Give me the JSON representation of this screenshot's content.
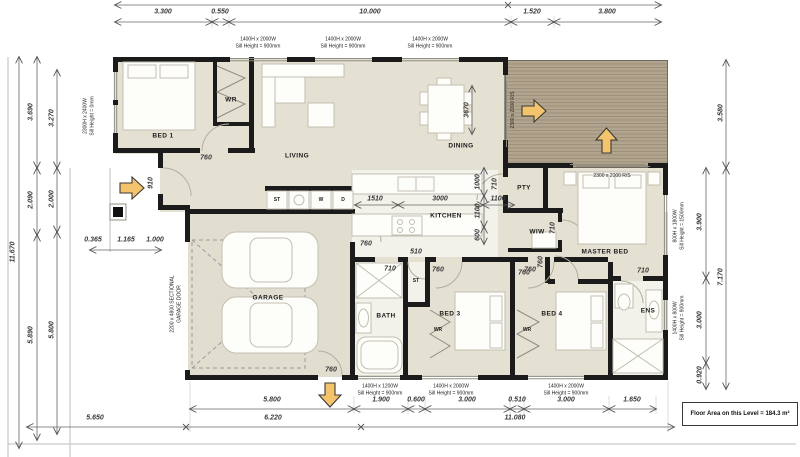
{
  "title": {
    "floor_area": "Floor Area on this Level = 184.3 m²"
  },
  "dims": {
    "top": [
      "3.300",
      "0.550",
      "10.000",
      "1.520",
      "3.800"
    ],
    "bottom_row1": [
      "5.800",
      "1.900",
      "0.600",
      "3.000",
      "0.510",
      "3.000",
      "1.650"
    ],
    "bottom_row2": [
      "5.650",
      "6.220",
      "11.080"
    ],
    "left_outer": "11.670",
    "left_mid": [
      "3.690",
      "2.090",
      "5.890"
    ],
    "left_inner": [
      "3.270",
      "2.000",
      "5.800"
    ],
    "left_entry": [
      "0.365",
      "1.165",
      "1.000"
    ],
    "right_outer": [
      "3.580",
      "7.170"
    ],
    "right_inner": [
      "3.900",
      "3.000",
      "0.920"
    ]
  },
  "interior_dims": {
    "kitchen_row": [
      "1510",
      "3000",
      "1100"
    ],
    "kitchen_col": [
      "1000",
      "1100",
      "600"
    ],
    "dining_table": "3670",
    "entry_door": "910",
    "bed1_door": "760",
    "hall_door": "760",
    "pantry_door": "710",
    "wiw_door": "710",
    "master_door_a": "760",
    "master_door_b": "760",
    "bath_door": "710",
    "store_door": "510",
    "bed3_door": "760",
    "bed4_door": "760",
    "ens_door": "710",
    "garage_rear_door": "760"
  },
  "rooms": {
    "bed1": "BED 1",
    "wr1": "WR",
    "living": "LIVING",
    "dining": "DINING",
    "kitchen": "KITCHEN",
    "pantry": "PTY",
    "wiw": "WIW",
    "master": "MASTER BED",
    "garage": "GARAGE",
    "laundry_store": "ST",
    "washer": "W",
    "dryer": "D",
    "hall_store": "ST",
    "bath": "BATH",
    "wr3": "WR",
    "bed3": "BED 3",
    "wr4": "WR",
    "bed4": "BED 4",
    "ens": "ENS"
  },
  "windows": {
    "top1": {
      "size": "1400H x 2000W",
      "sill": "Sill Height = 900mm"
    },
    "top2": {
      "size": "1400H x 2000W",
      "sill": "Sill Height = 900mm"
    },
    "top3": {
      "size": "1400H x 2000W",
      "sill": "Sill Height = 900mm"
    },
    "bed1": {
      "size": "2300H x 2400W",
      "sill": "Sill Height = 0mm"
    },
    "master": {
      "size": "800H x 1800W",
      "sill": "Sill Height = 1500mm"
    },
    "ens": {
      "size": "1400H x 800W",
      "sill": "Sill Height = 900mm"
    },
    "bath": {
      "size": "1400H x 1200W",
      "sill": "Sill Height = 900mm"
    },
    "bed3": {
      "size": "1400H x 2000W",
      "sill": "Sill Height = 900mm"
    },
    "bed4": {
      "size": "1400H x 2000W",
      "sill": "Sill Height = 900mm"
    }
  },
  "doors": {
    "deck_slider_side": "2300 x 2000 R/S",
    "deck_slider_front": "2300 x 2000 R/S",
    "garage_door_line1": "2200 x 4800 SECTIONAL",
    "garage_door_line2": "GARAGE DOOR"
  },
  "colors": {
    "wall": "#1b1b1b",
    "floor": "#e4e0d2",
    "deck": "#ac9f89",
    "arrow": "#f3c46b"
  }
}
